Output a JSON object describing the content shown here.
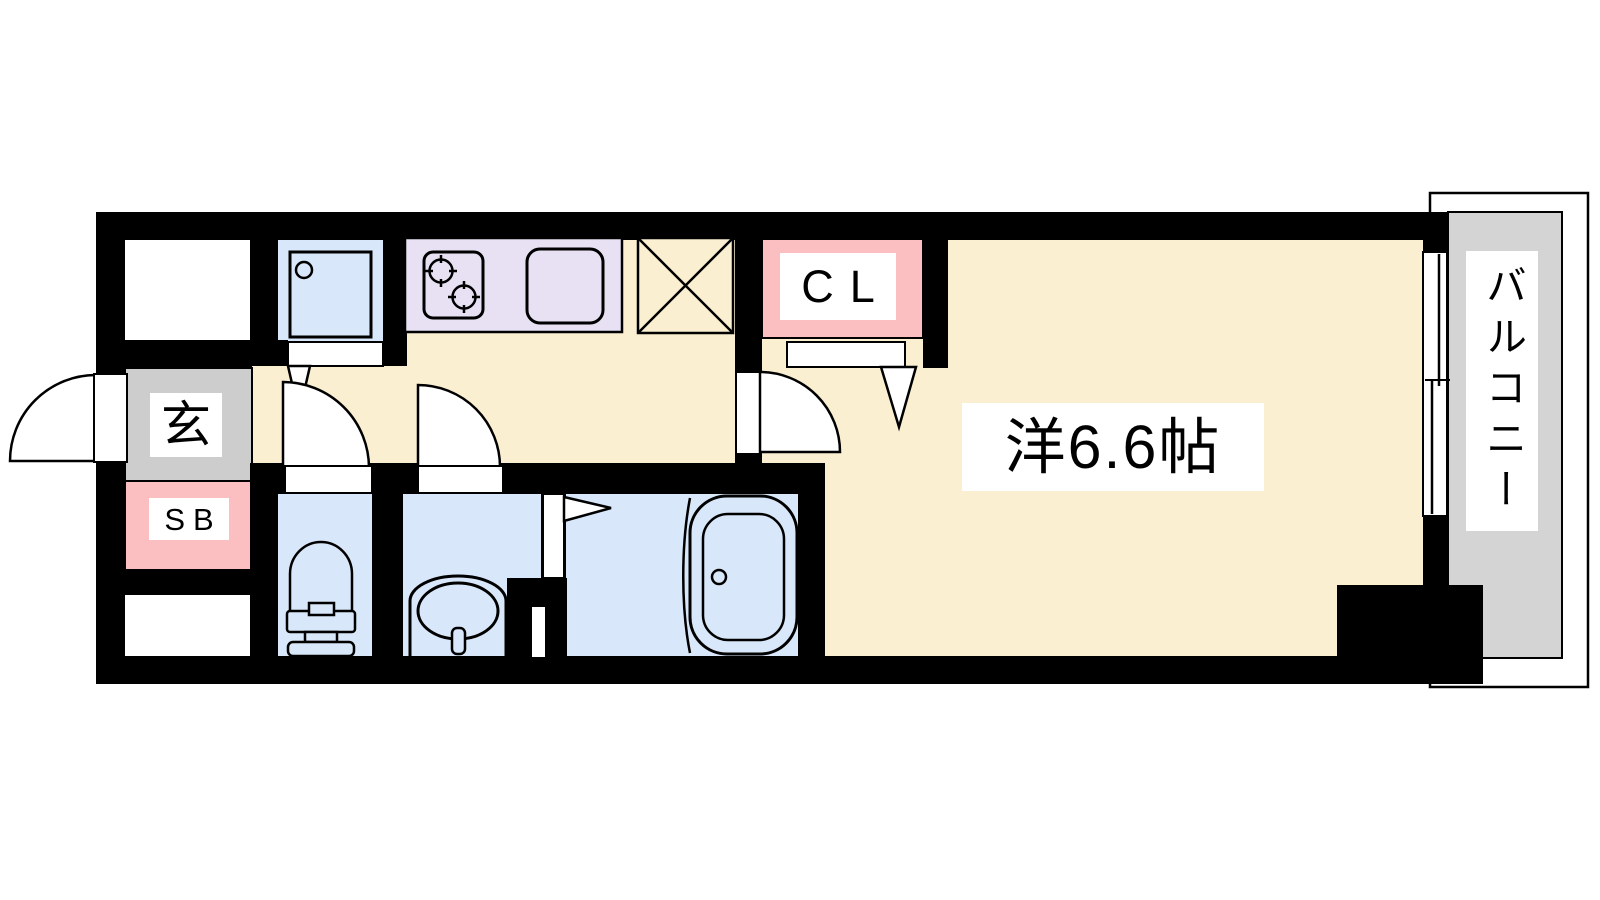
{
  "floorplan": {
    "title": "1K apartment floor plan",
    "labels": {
      "entrance": "玄",
      "shoe_box": "SB",
      "closet": "CL",
      "main_room": "洋6.6帖",
      "balcony": "バルコニー"
    },
    "colors": {
      "wall_black": "#000000",
      "floor_cream": "#fbefd1",
      "wet_area_blue": "#d8e7f9",
      "kitchen_lavender": "#e8e1f4",
      "accent_pink": "#fbbfc2",
      "entrance_gray": "#cdcdcd",
      "balcony_gray": "#d4d4d4",
      "line_black": "#000000",
      "background_white": "#ffffff"
    }
  }
}
